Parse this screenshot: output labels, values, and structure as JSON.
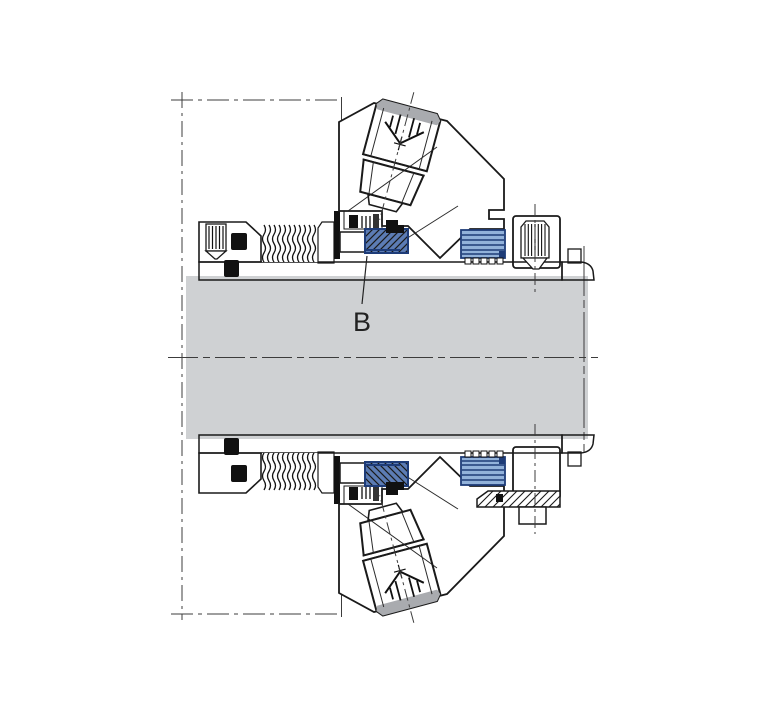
{
  "figure": {
    "label_b": "B"
  },
  "colors": {
    "background": "#FFFFFF",
    "shaft_gray": "#CFD1D3",
    "brass_yellow": "#F3D94F",
    "face_orange": "#F0A50C",
    "seat_blue": "#5C7CB4",
    "lamella_blue": "#92B2DA",
    "housing_gray": "#9C9EA1",
    "plug_gray": "#8F9298",
    "plug_highlight": "#A9ABAF",
    "outline_black": "#1A1A1A",
    "navy_blue": "#1E3C78",
    "line_gray": "#3C3C3C"
  }
}
